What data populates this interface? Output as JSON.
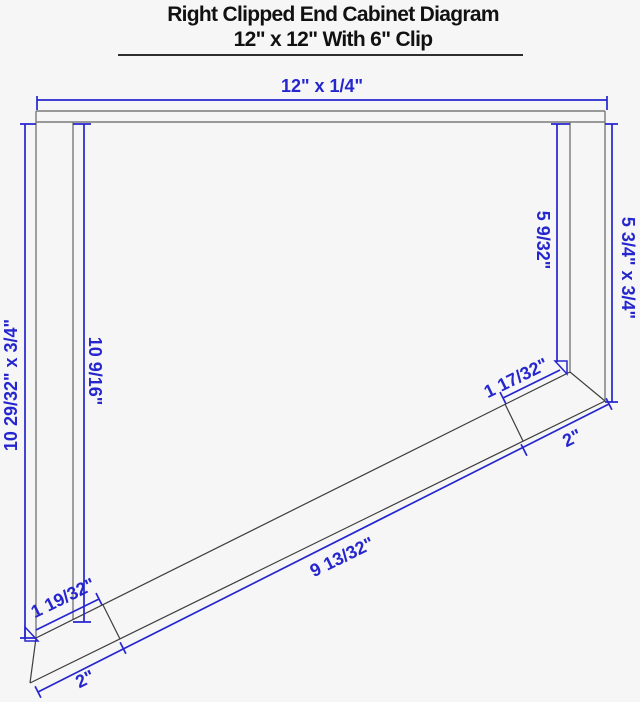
{
  "title": {
    "line1": "Right Clipped End Cabinet Diagram",
    "line2": "12\" x 12\" With 6\" Clip"
  },
  "dimensions": {
    "top_panel": "12\" x 1/4\"",
    "left_side_outer": "10 29/32\" x 3/4\"",
    "left_side_inner": "10 9/16\"",
    "right_side_inner": "5 9/32\"",
    "right_side_outer": "5 3/4\" x 3/4\"",
    "clip_end_top": "1 17/32\"",
    "clip_end_bottom": "2\"",
    "diagonal_front": "9 13/32\"",
    "left_end_top": "1 19/32\"",
    "left_end_bottom": "2\""
  },
  "colors": {
    "dimension_blue": "#2626cf",
    "panel_gray": "#7a7a7a",
    "diagonal_dark": "#3d3d3d",
    "background": "#f6f6f6",
    "title_black": "#111111"
  }
}
